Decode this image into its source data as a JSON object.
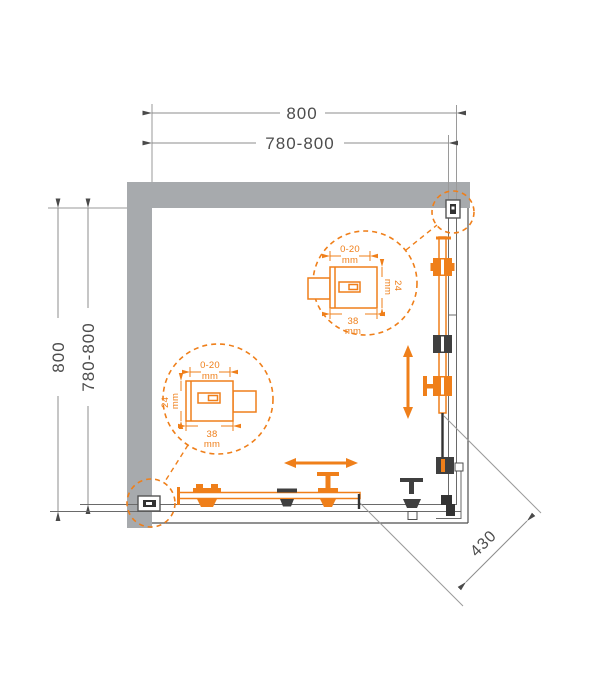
{
  "drawing": {
    "dimensions": {
      "top_outer": "800",
      "top_inner": "780-800",
      "left_outer": "800",
      "left_inner": "780-800",
      "diagonal_entry": "430"
    },
    "detail_upper": {
      "range": "0-20",
      "range_unit": "mm",
      "height": "24",
      "height_unit": "mm",
      "width": "38",
      "width_unit": "mm"
    },
    "detail_lower": {
      "range": "0-20",
      "range_unit": "mm",
      "height": "24",
      "height_unit": "mm",
      "width": "38",
      "width_unit": "mm"
    },
    "colors": {
      "accent_orange": "#ef7f1a",
      "wall_gray": "#a7aaad",
      "line_dark": "#4f4f4f",
      "dim_gray": "#8c8c8c",
      "roller_dark": "#3f3f3f"
    }
  }
}
